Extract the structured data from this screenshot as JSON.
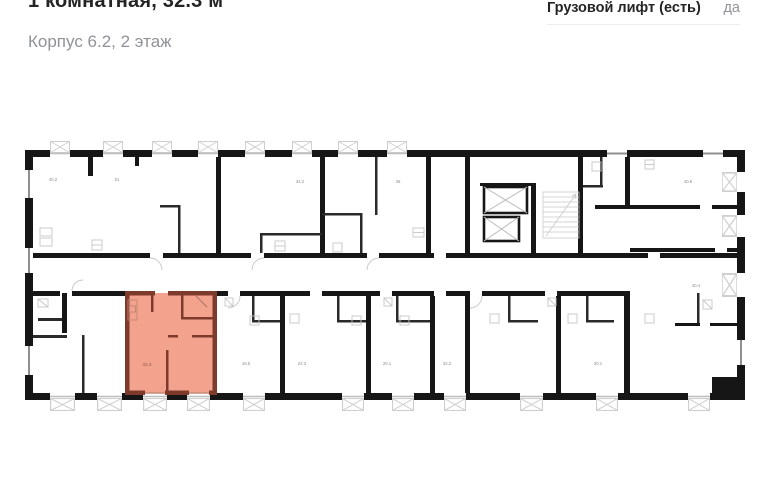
{
  "header": {
    "title": "1 комнатная, 32.3 м²",
    "subtitle": "Корпус 6.2, 2 этаж"
  },
  "specs": {
    "freight_elevator_label": "Грузовой лифт (есть)",
    "freight_elevator_value": "да"
  },
  "floor_plan": {
    "highlighted_apartment": {
      "area_label": "32.3",
      "fill": "#f2a28d",
      "wall": "#7e3b2b"
    },
    "room_labels": {
      "top_1": "40.2",
      "top_2": "51",
      "top_3": "34.2",
      "top_4": "36",
      "right_top": "40.5",
      "right_mid": "40.4",
      "selected": "32.3",
      "bottom_2": "19.5",
      "bottom_3": "22.3",
      "bottom_4": "20.1",
      "bottom_5": "32.2",
      "bottom_6": "20.1"
    }
  }
}
